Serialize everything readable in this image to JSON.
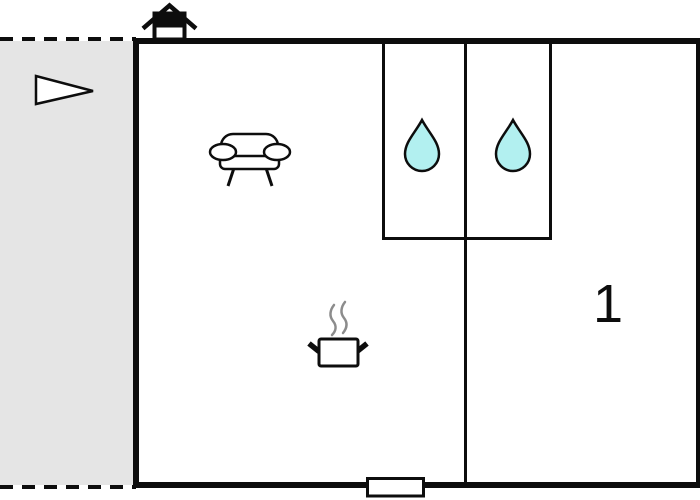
{
  "colors": {
    "background": "#ffffff",
    "wall": "#0d0d0d",
    "terrace_fill": "#e5e5e5",
    "water_drop_fill": "#b2f0f0",
    "steam": "#8c8c8c",
    "icon_fill": "#ffffff"
  },
  "floorplan": {
    "room_label": "1",
    "areas": {
      "terrace": "terrace (dashed outdoor area)",
      "living_room": "living room with sofa and cooking area",
      "bathrooms": "two water rooms with water drops",
      "room_1": "room 1"
    },
    "icons": {
      "entrance_arrow": "entrance-arrow-icon",
      "house": "house-orientation-icon",
      "sofa": "sofa-icon",
      "water_drop": "water-drop-icon",
      "cooking_pot": "cooking-pot-icon",
      "window": "window-marker"
    }
  }
}
